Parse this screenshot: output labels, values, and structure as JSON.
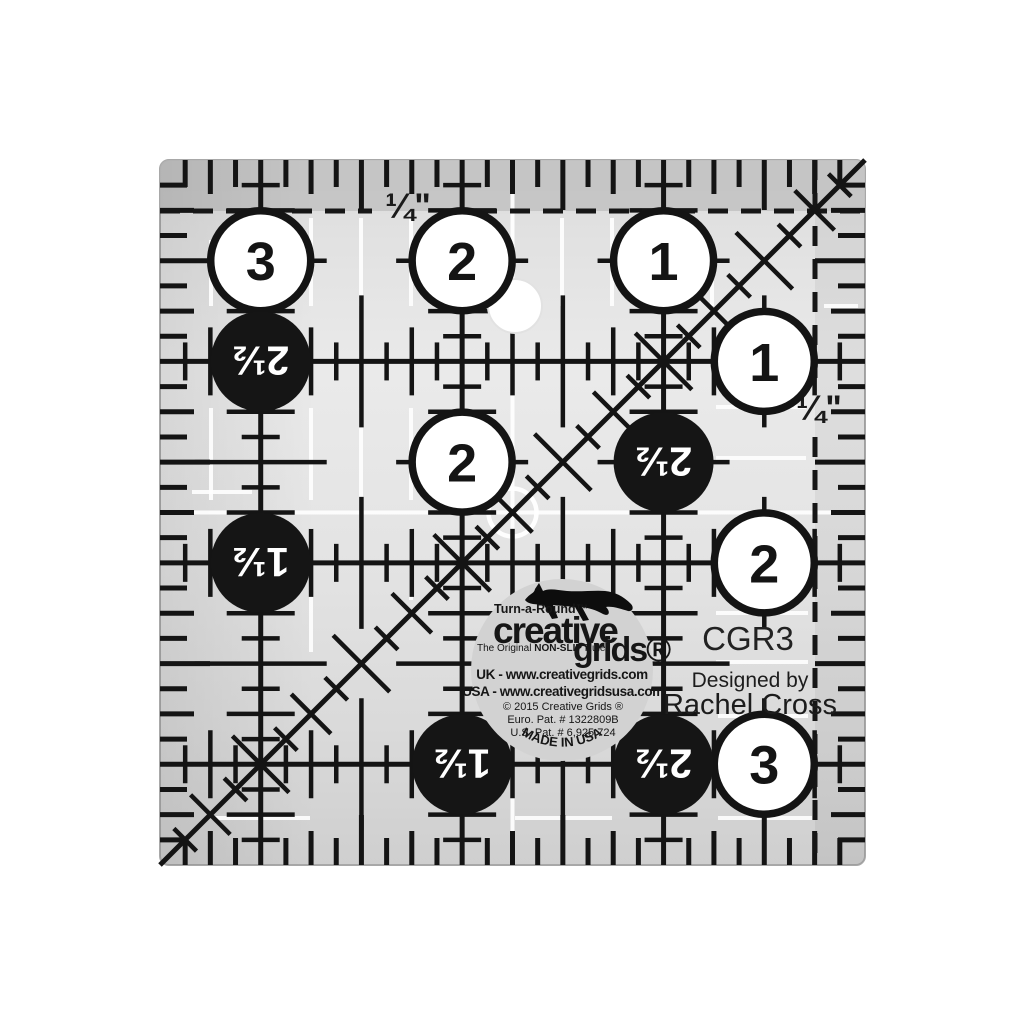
{
  "product": {
    "model": "CGR3",
    "designed_by_label": "Designed by",
    "designer_name": "Rachel Cross"
  },
  "seam_labels": {
    "top": "¼\"",
    "right": "¼\""
  },
  "circles": {
    "white": [
      {
        "label": "3",
        "x_in": 0.5,
        "y_in": 0.5
      },
      {
        "label": "2",
        "x_in": 1.5,
        "y_in": 0.5
      },
      {
        "label": "1",
        "x_in": 2.5,
        "y_in": 0.5
      },
      {
        "label": "1",
        "x_in": 3.0,
        "y_in": 1.0
      },
      {
        "label": "2",
        "x_in": 1.5,
        "y_in": 1.5
      },
      {
        "label": "2",
        "x_in": 3.0,
        "y_in": 2.0
      },
      {
        "label": "3",
        "x_in": 3.0,
        "y_in": 3.0
      }
    ],
    "black": [
      {
        "label": "2½",
        "x_in": 0.5,
        "y_in": 1.0
      },
      {
        "label": "2½",
        "x_in": 2.5,
        "y_in": 1.5
      },
      {
        "label": "1½",
        "x_in": 0.5,
        "y_in": 2.0
      },
      {
        "label": "1½",
        "x_in": 1.5,
        "y_in": 3.0
      },
      {
        "label": "2½",
        "x_in": 2.5,
        "y_in": 3.0
      }
    ]
  },
  "logo": {
    "turn_a_round": "Turn-a-Round™",
    "brand_top": "creative",
    "brand_bottom": "grids®",
    "tagline_prefix": "The Original ",
    "tagline_bold": "NON-SLIP",
    "tagline_suffix": " Ruler",
    "uk_line": "UK - www.creativegrids.com",
    "usa_line": "USA - www.creativegridsusa.com",
    "copyright_line": "© 2015 Creative Grids ®",
    "euro_patent": "Euro. Pat. # 1322809B",
    "us_patent": "U.S. Pat. # 6,925,724",
    "made_in": "MADE IN USA"
  },
  "colors": {
    "background": "#ffffff",
    "body_gray_top": "#c9c9c9",
    "body_gray_mid": "#eaeaea",
    "body_gray_bottom": "#d0d0d0",
    "top_band": "#c3c3c3",
    "line_black": "#141414",
    "guide_white": "#ffffff",
    "circle_white": "#ffffff",
    "circle_black": "#151515",
    "logo_circle_gray": "#d2d2d2"
  }
}
